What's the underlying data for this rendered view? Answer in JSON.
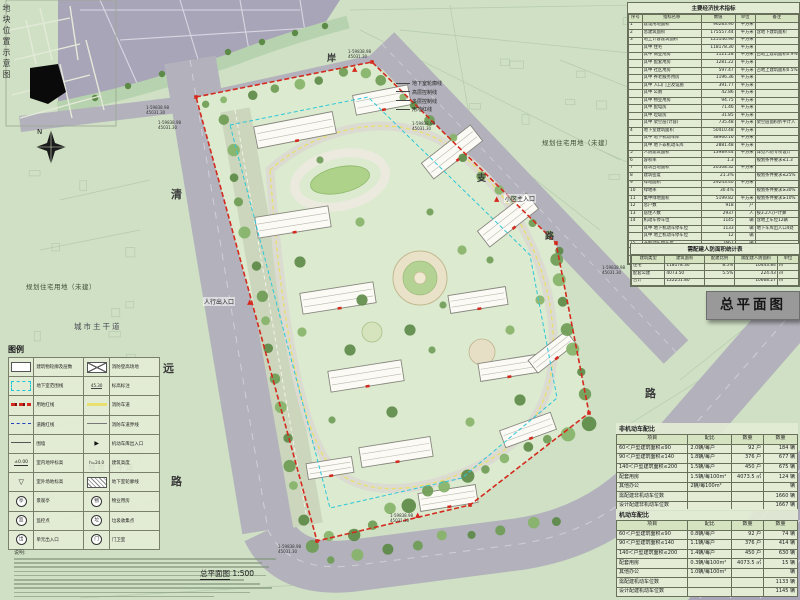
{
  "sheet": {
    "title_box": "总平面图",
    "scale_name": "总平面图",
    "scale_value": "1:500",
    "inset_title": "地块位置示意图",
    "compass_letter": "N",
    "notes_title": "说明:"
  },
  "map_labels": {
    "planning_land_left": "规划住宅用地（未建）",
    "planning_land_top": "规划住宅用地（未建）",
    "city_main_road_1": "城市主干道",
    "city_main_road_2": "城市主干道",
    "green_land": "绿地",
    "main_entrance": "小区主入口",
    "pedestrian_entrance": "人行出入口",
    "road_chars": [
      "清",
      "远",
      "路",
      "支",
      "路",
      "路",
      "环",
      "六",
      "岸"
    ],
    "boundary_notes": [
      "地下室轮廓线",
      "高层控制线",
      "多层控制线",
      "用地红线"
    ],
    "coord_a": "1-59838.98",
    "coord_b": "45031.30"
  },
  "econ_table": {
    "title": "主要经济技术指标",
    "header": [
      "序号",
      "指标名称",
      "数值",
      "单位",
      "备注"
    ],
    "rows": [
      [
        "1",
        "建设用地面积",
        "96283.90",
        "平方米",
        ""
      ],
      [
        "2",
        "总建筑面积",
        "175557.44",
        "平方米",
        "含地下建筑面积"
      ],
      [
        "3",
        "地上计容建筑面积",
        "125146.96",
        "平方米",
        ""
      ],
      [
        "",
        "其中 住宅",
        "118178.30",
        "平方米",
        ""
      ],
      [
        "",
        "其中 商业用房",
        "1121.28",
        "平方米",
        "占地上建筑面积0.9%"
      ],
      [
        "",
        "其中 配套用房",
        "1281.22",
        "平方米",
        ""
      ],
      [
        "",
        "其中 社区用房",
        "597.47",
        "平方米",
        "占地上建筑面积0.5%"
      ],
      [
        "",
        "其中 养老服务用房",
        "1196.36",
        "平方米",
        ""
      ],
      [
        "",
        "其中 入口门卫及设施",
        "391.77",
        "平方米",
        ""
      ],
      [
        "",
        "其中 公厕",
        "42.86",
        "平方米",
        ""
      ],
      [
        "",
        "其中 物业用房",
        "94.75",
        "平方米",
        ""
      ],
      [
        "",
        "其中 配电房",
        "71.46",
        "平方米",
        ""
      ],
      [
        "",
        "其中 垃圾房",
        "31.85",
        "平方米",
        ""
      ],
      [
        "",
        "其中 架空层(计容)",
        "735.48",
        "平方米",
        "架空层面积折半计入"
      ],
      [
        "4",
        "地下室建筑面积",
        "50410.48",
        "平方米",
        ""
      ],
      [
        "",
        "其中 地下机动车库",
        "38960.16",
        "平方米",
        ""
      ],
      [
        "",
        "其中 地下非机动车库",
        "2881.48",
        "平方米",
        ""
      ],
      [
        "5",
        "人防建筑面积",
        "13989.44",
        "平方米",
        "详见人防专项设计"
      ],
      [
        "6",
        "容积率",
        "1.3",
        "",
        "规划条件要求≤1.3"
      ],
      [
        "7",
        "建筑占地面积",
        "20508.32",
        "平方米",
        ""
      ],
      [
        "8",
        "建筑密度",
        "21.3%",
        "",
        "规划条件要求≤25%"
      ],
      [
        "9",
        "绿地面积",
        "29243.40",
        "平方米",
        ""
      ],
      [
        "10",
        "绿地率",
        "30.4%",
        "",
        "规划条件要求≥30%"
      ],
      [
        "11",
        "集中绿地面积",
        "5199.82",
        "平方米",
        "规划条件要求≥10%"
      ],
      [
        "12",
        "总户数",
        "918",
        "户",
        ""
      ],
      [
        "13",
        "居住人数",
        "2937",
        "人",
        "按3.2人/户计算"
      ],
      [
        "14",
        "机动车停车位",
        "1145",
        "辆",
        "含地上车位12辆"
      ],
      [
        "",
        "其中 地下机动车停车位",
        "1133",
        "辆",
        "地下车库出入口4处"
      ],
      [
        "",
        "其中 地上机动车停车位",
        "12",
        "辆",
        ""
      ],
      [
        "15",
        "非机动车停车位",
        "1667",
        "辆",
        ""
      ],
      [
        "",
        "其中 地下非机动车停车位",
        "1586",
        "辆",
        ""
      ],
      [
        "",
        "其中 地上非机动车停车位",
        "81",
        "辆",
        ""
      ]
    ]
  },
  "renfang_table": {
    "title": "需配建人防面积统计表",
    "header": [
      "建筑类型",
      "建筑面积",
      "配建比例",
      "需配建人防面积",
      "单位"
    ],
    "rows": [
      [
        "住宅",
        "118178.30",
        "8.5%",
        "10443.84",
        "㎡"
      ],
      [
        "配套公建",
        "4073.50",
        "5.5%",
        "224.43",
        "㎡"
      ],
      [
        "合计",
        "122251.80",
        "",
        "10668.27",
        "㎡"
      ]
    ]
  },
  "nonmotor_table": {
    "title": "非机动车配比",
    "header": [
      "项目",
      "配比",
      "数量",
      "数量"
    ],
    "rows": [
      [
        "60＜户型建筑面积≤90",
        "2.0辆/每户",
        "92 户",
        "184 辆"
      ],
      [
        "90＜户型建筑面积≤140",
        "1.8辆/每户",
        "376 户",
        "677 辆"
      ],
      [
        "140＜户型建筑面积≤200",
        "1.5辆/每户",
        "450 户",
        "675 辆"
      ],
      [
        "配套用房",
        "1.5辆/每100m²",
        "4073.5 ㎡",
        "124 辆"
      ],
      [
        "其他办公",
        "2辆/每100m²",
        "",
        "辆"
      ],
      [
        "需配建非机动车位数",
        "",
        "",
        "1660 辆"
      ],
      [
        "设计配建非机动车位数",
        "",
        "",
        "1667 辆"
      ]
    ]
  },
  "motor_table": {
    "title": "机动车配比",
    "header": [
      "项目",
      "配比",
      "数量",
      "数量"
    ],
    "rows": [
      [
        "60＜户型建筑面积≤90",
        "0.8辆/每户",
        "92 户",
        "74 辆"
      ],
      [
        "90＜户型建筑面积≤140",
        "1.1辆/每户",
        "376 户",
        "414 辆"
      ],
      [
        "140＜户型建筑面积≤200",
        "1.4辆/每户",
        "450 户",
        "630 辆"
      ],
      [
        "配套用房",
        "0.3辆/每100m²",
        "4073.5 ㎡",
        "15 辆"
      ],
      [
        "其他办公",
        "1.0辆/每100m²",
        "",
        "辆"
      ],
      [
        "需配建机动车位数",
        "",
        "",
        "1133 辆"
      ],
      [
        "设计配建机动车位数",
        "",
        "",
        "1145 辆"
      ]
    ]
  },
  "legend": {
    "title": "图例",
    "items": [
      {
        "sym": "bldg",
        "label": "建筑物轮廓及层数"
      },
      {
        "sym": "xbox",
        "label": "消防登高场地"
      },
      {
        "sym": "cyan",
        "label": "地下室范围线"
      },
      {
        "sym": "leader",
        "label": "标高标注"
      },
      {
        "sym": "redline",
        "label": "用地红线"
      },
      {
        "sym": "yellow",
        "label": "消防车道"
      },
      {
        "sym": "blueline",
        "label": "道路红线"
      },
      {
        "sym": "thin",
        "label": "消防车道界线"
      },
      {
        "sym": "fence",
        "label": "围墙"
      },
      {
        "sym": "arrow",
        "label": "机动车库出入口"
      },
      {
        "sym": "pm",
        "label": "室内地坪标高"
      },
      {
        "sym": "hval",
        "label": "建筑高度"
      },
      {
        "sym": "tri",
        "label": "室外场地标高"
      },
      {
        "sym": "hatch",
        "label": "地下室轮廓线"
      },
      {
        "sym": "circ:亭",
        "label": "景观亭"
      },
      {
        "sym": "circ:物",
        "label": "物业用房"
      },
      {
        "sym": "circ:监",
        "label": "监控点"
      },
      {
        "sym": "circ:垃",
        "label": "垃圾收集点"
      },
      {
        "sym": "circ:出",
        "label": "单元出入口"
      },
      {
        "sym": "circ:门",
        "label": "门卫室"
      }
    ]
  },
  "colors": {
    "site_boundary_red": "#d42a1e",
    "background_green": "#cfe0c4",
    "zone_purple": "#a9a5b9",
    "road_gray": "#b3b2bc",
    "table_bg": "#e3ecd5",
    "title_box_bg": "#9a999a",
    "tree_green": "#6e9c55",
    "fire_lane_yellow": "#e8df6e",
    "basement_cyan": "#2cc8d8"
  }
}
